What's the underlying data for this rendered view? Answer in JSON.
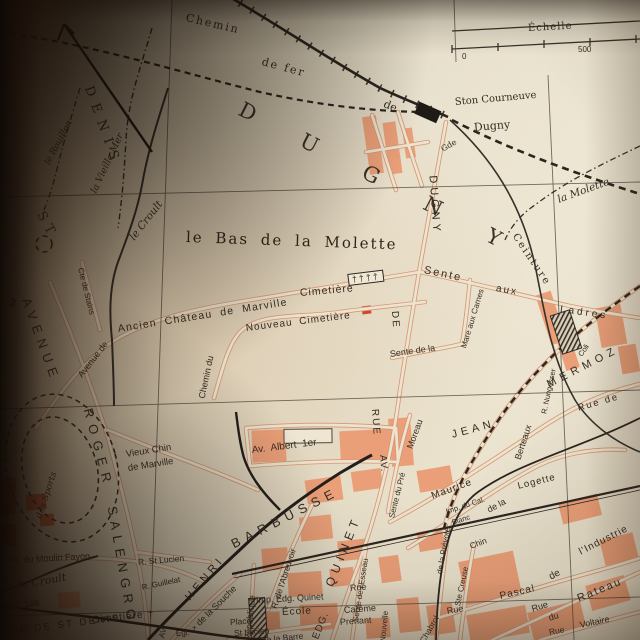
{
  "colors": {
    "paper": "#e3dac3",
    "block_pink": "#ea9f78",
    "block_red": "#d96a43",
    "line_dark": "#2e2822",
    "label_dark": "#362d22",
    "red_text": "#96412f"
  },
  "labels": {
    "dugny_commune": {
      "text": "DUGNY"
    },
    "st": {
      "text": "ST"
    },
    "denis": {
      "text": "DENIS"
    },
    "le_bas": {
      "text": "le Bas de la Molette"
    },
    "chemin": {
      "text": "Chemin"
    },
    "de_fer": {
      "text": "de fer"
    },
    "de_rail": {
      "text": "de"
    },
    "gde": {
      "text": "Gde"
    },
    "ston": {
      "text": "Ston Courneuve"
    },
    "dugny_station": {
      "text": "Dugny"
    },
    "echelle": {
      "text": "Échelle"
    },
    "zero": {
      "text": "0"
    },
    "five_hundred": {
      "text": "500"
    },
    "rouillon": {
      "text": "le Rouillon"
    },
    "vieille_mer": {
      "text": "la Vieille Mer"
    },
    "croult_top": {
      "text": "le Croult"
    },
    "croult_bottom": {
      "text": "le Croult"
    },
    "molette_stream": {
      "text": "la Molette"
    },
    "ceinture": {
      "text": "Ceinture"
    },
    "ancien": {
      "text": "Ancien Château de Marville"
    },
    "avenue_de": {
      "text": "Avenue de"
    },
    "cte_stains": {
      "text": "Cte de Stains"
    },
    "cimetiere_c": {
      "text": "Cimetière"
    },
    "crosses": {
      "text": "††††"
    },
    "nouveau": {
      "text": "Nouveau Cimetière"
    },
    "chemin_du": {
      "text": "Chemin du"
    },
    "sente1": {
      "text": "Sente"
    },
    "aux1": {
      "text": "aux"
    },
    "ladres": {
      "text": "Ladres"
    },
    "sente_mare": {
      "text": "Sente de la"
    },
    "mare_carnes": {
      "text": "Mare aux Carnes"
    },
    "rue_v": {
      "text": "RUE"
    },
    "de_v": {
      "text": "DE"
    },
    "dugny_v": {
      "text": "DUGNY"
    },
    "av_v": {
      "text": "AV."
    },
    "sente_pre": {
      "text": "Sente du Pré"
    },
    "moreau": {
      "text": "Moreau"
    },
    "maurice": {
      "text": "Maurice"
    },
    "berteaux": {
      "text": "Berteaux"
    },
    "jean": {
      "text": "JEAN"
    },
    "mermoz": {
      "text": "MERMOZ"
    },
    "nungesser": {
      "text": "R. Nungesser"
    },
    "coli": {
      "text": "Coli"
    },
    "rue_de_r": {
      "text": "Rue de"
    },
    "logette": {
      "text": "Logette"
    },
    "de_la_log": {
      "text": "de la"
    },
    "imp_cal": {
      "text": "Imp. du Cal."
    },
    "blanc": {
      "text": "Blanc"
    },
    "prevote": {
      "text": "de la Prévoté"
    },
    "chin": {
      "text": "Chin"
    },
    "ste_creuse": {
      "text": "Ste Creuse"
    },
    "pascal": {
      "text": "Pascal"
    },
    "rue_pascal": {
      "text": "Rue"
    },
    "de_ind": {
      "text": "de"
    },
    "industrie": {
      "text": "l'Industrie"
    },
    "rateau_rue": {
      "text": "Rue"
    },
    "rateau_du": {
      "text": "du"
    },
    "rateau": {
      "text": "Rateau"
    },
    "voltaire_rue": {
      "text": "Rue"
    },
    "voltaire": {
      "text": "Voltaire"
    },
    "chabrol": {
      "text": "Chabrol"
    },
    "nouvelle": {
      "text": "Nouvelle"
    },
    "esseau": {
      "text": "Sente de l'Esseau"
    },
    "esseau_rue": {
      "text": "Rue"
    },
    "edg": {
      "text": "EDG."
    },
    "quinet": {
      "text": "QUINET"
    },
    "careme": {
      "text": "Carême"
    },
    "prenant": {
      "text": "Prenant"
    },
    "imp_edg": {
      "text": "Imp. Edg. Quinet"
    },
    "ecole": {
      "text": "École"
    },
    "republique": {
      "text": "République"
    },
    "souche": {
      "text": "de la Souche"
    },
    "abreuvoir": {
      "text": "R. de l'Abreuvoir"
    },
    "henri": {
      "text": "HENRI"
    },
    "barbusse": {
      "text": "BARBUSSE"
    },
    "barre": {
      "text": "de la Barre"
    },
    "place": {
      "text": "Place"
    },
    "st_lucien_pl": {
      "text": "St Lucien"
    },
    "r_st_lucien": {
      "text": "R. St Lucien"
    },
    "guillelat": {
      "text": "R. Guillelat"
    },
    "moulin_fayon": {
      "text": "R. du Moulin Fayon"
    },
    "n186": {
      "text": "N. 186"
    },
    "cimetiere_b": {
      "text": "Cimetière"
    },
    "cross_b": {
      "text": "†"
    },
    "av_b": {
      "text": "AV."
    },
    "egl": {
      "text": "Egl."
    },
    "cross_egl": {
      "text": "†"
    },
    "albert": {
      "text": "Av. Albert 1er"
    },
    "vieux1": {
      "text": "Vieux Chin"
    },
    "vieux2": {
      "text": "de Marville"
    },
    "avenue_big": {
      "text": "AVENUE"
    },
    "roger": {
      "text": "ROGER"
    },
    "salengro": {
      "text": "SALENGRO"
    },
    "sports": {
      "text": "des Sports"
    },
    "grid2": {
      "text": "2"
    },
    "grid3": {
      "text": "3"
    },
    "rue_st_denis": {
      "text": "RUE DE ST DENIS"
    }
  }
}
